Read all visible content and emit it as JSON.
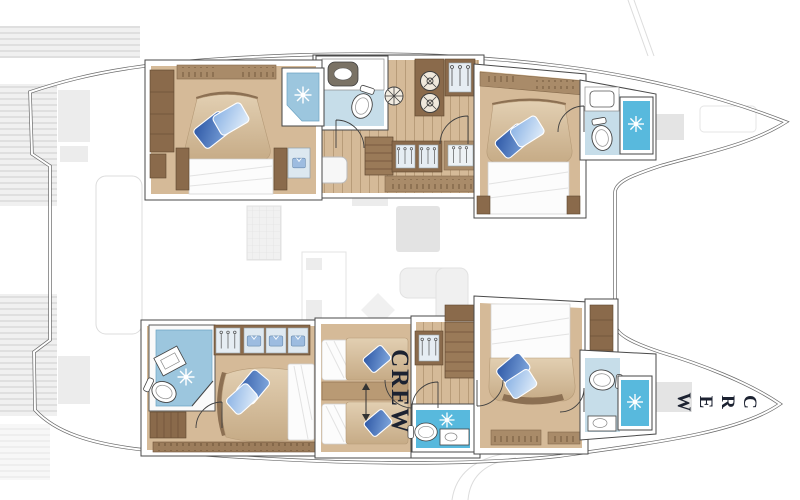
{
  "labels": {
    "crew_cabin": "CREW",
    "crew_bow": "CREW"
  },
  "colors": {
    "hull_line": "#6a6a6a",
    "wall_line": "#4a4a4a",
    "wood_floor": "#d5ba98",
    "wood_plank": "#b99a74",
    "wood_dark": "#8a6a4b",
    "wood_mid": "#a98b69",
    "bath_light": "#c6dde9",
    "bath_medium": "#9cc6de",
    "bath_vivid": "#58b9dd",
    "pillow_dark": "#2d57a5",
    "pillow_light": "#8ab2e4",
    "duvet": "#d9c4a4",
    "linen": "#fcfcfc",
    "ghost": "#ececec",
    "label_ink": "#1c2231"
  },
  "rooms": [
    {
      "id": "port-aft-cabin",
      "features": [
        "double-bed-icon",
        "shower-icon",
        "wardrobe-icon"
      ]
    },
    {
      "id": "port-aft-bathroom",
      "features": [
        "toilet-icon",
        "sink-icon"
      ]
    },
    {
      "id": "port-companionway",
      "features": [
        "stairs-icon",
        "washer-dryer-icon",
        "hanger-closet-icon"
      ]
    },
    {
      "id": "port-forward-cabin",
      "features": [
        "double-bed-icon",
        "shelf-icon"
      ]
    },
    {
      "id": "port-forward-bathroom",
      "features": [
        "toilet-icon",
        "sink-icon",
        "shower-icon"
      ]
    },
    {
      "id": "starboard-aft-cabin",
      "features": [
        "double-bed-icon",
        "wardrobe-icon",
        "bench-icon"
      ]
    },
    {
      "id": "starboard-aft-bathroom",
      "features": [
        "toilet-icon",
        "sink-icon",
        "shower-icon"
      ]
    },
    {
      "id": "crew-cabin",
      "features": [
        "bunk-icon",
        "bunk-icon",
        "ladder-arrow-icon"
      ]
    },
    {
      "id": "crew-bathroom",
      "features": [
        "toilet-icon",
        "sink-icon",
        "shower-icon"
      ]
    },
    {
      "id": "starboard-forward-cabin",
      "features": [
        "double-bed-icon",
        "wardrobe-icon"
      ]
    },
    {
      "id": "starboard-forward-bathroom",
      "features": [
        "toilet-icon",
        "sink-icon",
        "shower-icon"
      ]
    },
    {
      "id": "bow-crew-area",
      "features": []
    }
  ]
}
